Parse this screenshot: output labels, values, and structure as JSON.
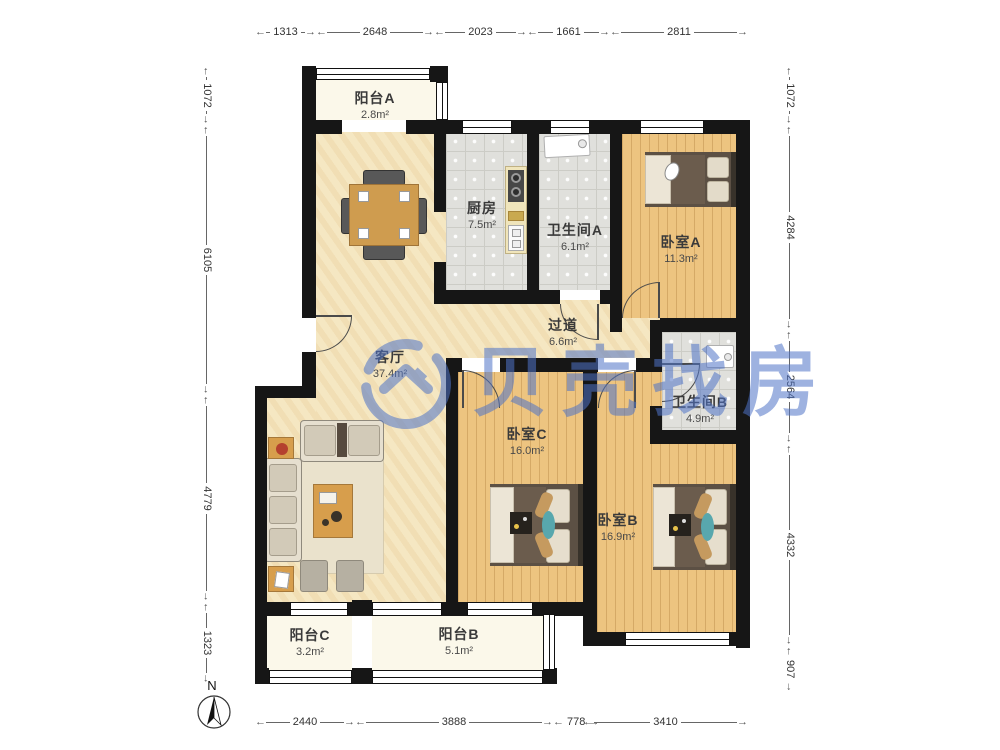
{
  "watermark": {
    "text": "贝壳找房",
    "color": "#4f74c8"
  },
  "compass": {
    "label": "N"
  },
  "rooms": [
    {
      "name": "阳台A",
      "area": "2.8m²"
    },
    {
      "name": "厨房",
      "area": "7.5m²"
    },
    {
      "name": "卫生间A",
      "area": "6.1m²"
    },
    {
      "name": "卧室A",
      "area": "11.3m²"
    },
    {
      "name": "过道",
      "area": "6.6m²"
    },
    {
      "name": "客厅",
      "area": "37.4m²"
    },
    {
      "name": "卫生间B",
      "area": "4.9m²"
    },
    {
      "name": "卧室C",
      "area": "16.0m²"
    },
    {
      "name": "卧室B",
      "area": "16.9m²"
    },
    {
      "name": "阳台C",
      "area": "3.2m²"
    },
    {
      "name": "阳台B",
      "area": "5.1m²"
    }
  ],
  "dimensions": {
    "top": [
      "1313",
      "2648",
      "2023",
      "1661",
      "2811"
    ],
    "bottom": [
      "2440",
      "3888",
      "778",
      "3410"
    ],
    "left": [
      "1072",
      "6105",
      "4779",
      "1323"
    ],
    "right": [
      "1072",
      "4284",
      "2564",
      "4332",
      "907"
    ]
  }
}
